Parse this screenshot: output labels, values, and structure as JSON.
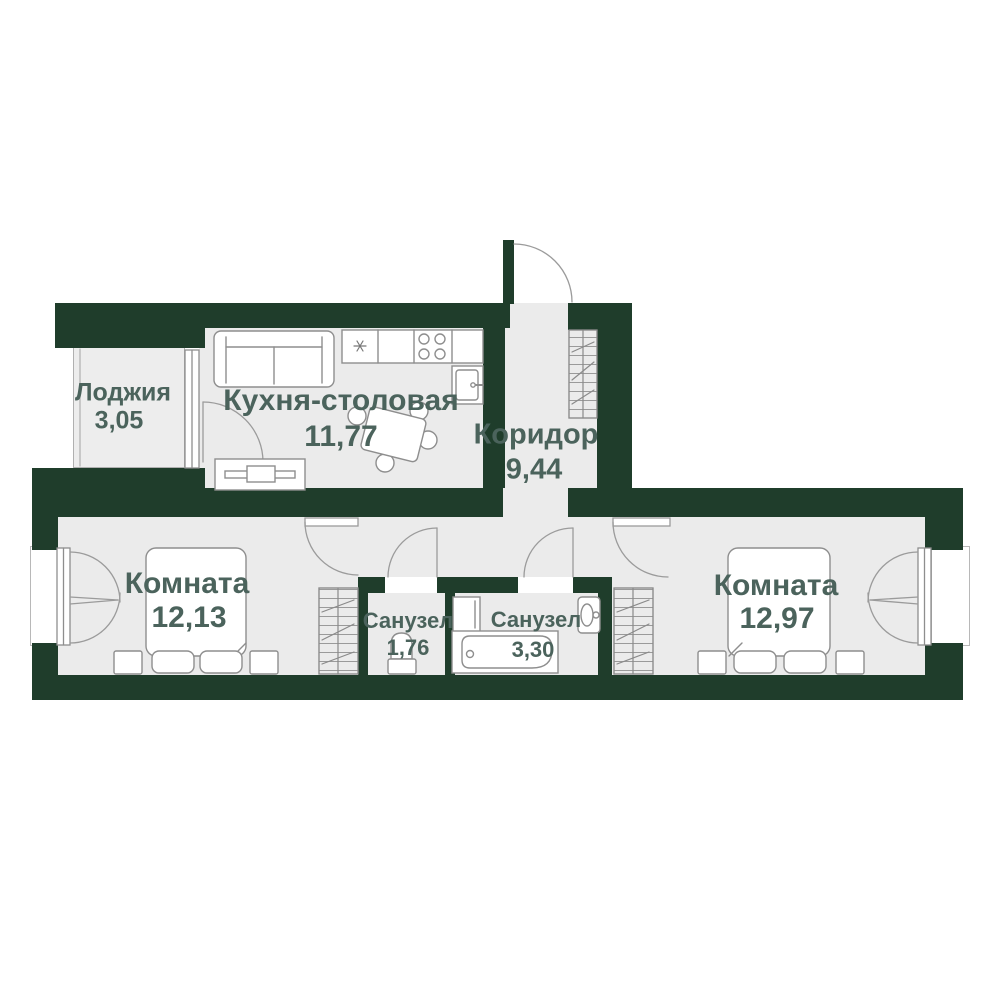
{
  "meta": {
    "type": "apartment-floor-plan",
    "language": "ru"
  },
  "colors": {
    "wall": "#1f3d2b",
    "floor": "#ebebeb",
    "floor_light": "#ededed",
    "label": "#4b635c",
    "line": "#8e8e8e"
  },
  "rooms": {
    "loggia": {
      "name": "Лоджия",
      "area": "3,05"
    },
    "kitchen": {
      "name": "Кухня-столовая",
      "area": "11,77"
    },
    "corridor": {
      "name": "Коридор",
      "area": "9,44"
    },
    "room_left": {
      "name": "Комната",
      "area": "12,13"
    },
    "bath_small": {
      "name": "Санузел",
      "area": "1,76"
    },
    "bath_large": {
      "name": "Санузел",
      "area": "3,30"
    },
    "room_right": {
      "name": "Комната",
      "area": "12,97"
    }
  }
}
